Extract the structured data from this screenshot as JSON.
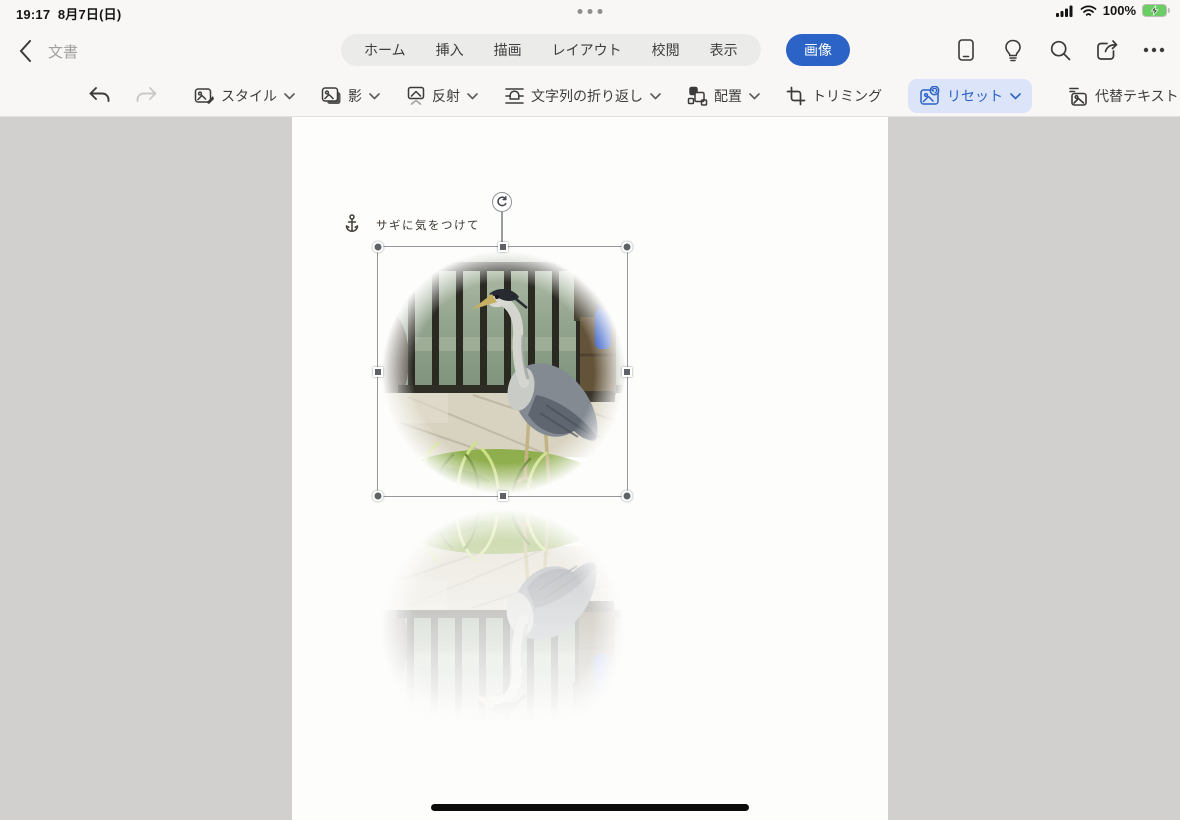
{
  "status_bar": {
    "time": "19:17",
    "date": "8月7日(日)",
    "battery": "100%"
  },
  "nav": {
    "back": "文書",
    "tabs": [
      "ホーム",
      "挿入",
      "描画",
      "レイアウト",
      "校閲",
      "表示",
      "画像"
    ],
    "active_tab": "画像"
  },
  "toolbar": {
    "style": "スタイル",
    "shadow": "影",
    "reflection": "反射",
    "text_wrap": "文字列の折り返し",
    "arrange": "配置",
    "crop": "トリミング",
    "reset": "リセット",
    "alt_text": "代替テキスト"
  },
  "document": {
    "anchor_caption": "サギに気をつけて"
  },
  "colors": {
    "accent": "#2b63c7",
    "reset_pill_bg": "#dbe4f8",
    "battery_green": "#6ace64",
    "page_bg": "#fdfdfc",
    "canvas_bg": "#d1d0cf",
    "chrome_bg": "#f8f7f5"
  },
  "icons": {
    "status": [
      "cellular-signal-icon",
      "wifi-icon",
      "battery-charging-icon"
    ],
    "nav_left": [
      "chevron-left-icon"
    ],
    "nav_right": [
      "phone-icon",
      "lightbulb-icon",
      "search-icon",
      "share-icon",
      "ellipsis-icon"
    ],
    "toolbar": [
      "undo-icon",
      "redo-icon",
      "picture-style-icon",
      "picture-shadow-icon",
      "picture-reflection-icon",
      "text-wrap-icon",
      "arrange-icon",
      "crop-icon",
      "picture-reset-icon",
      "alt-text-icon"
    ],
    "document": [
      "anchor-icon",
      "rotate-handle-icon"
    ]
  }
}
